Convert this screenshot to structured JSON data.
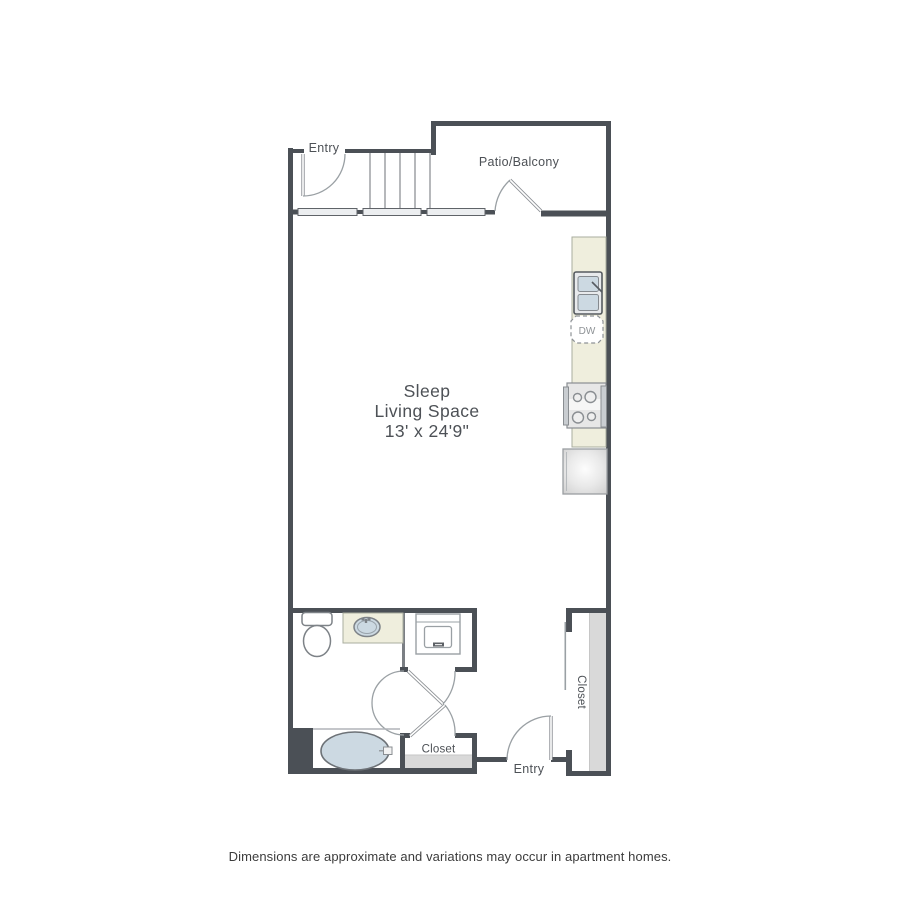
{
  "floor_plan": {
    "labels": {
      "entry_top": "Entry",
      "patio_balcony": "Patio/Balcony",
      "living_line1": "Sleep",
      "living_line2": "Living Space",
      "living_dimensions": "13' x 24'9\"",
      "dishwasher": "DW",
      "closet_bottom": "Closet",
      "closet_right": "Closet",
      "entry_bottom": "Entry"
    },
    "disclaimer": "Dimensions are approximate and variations may occur in apartment homes.",
    "colors": {
      "wall": "#4b5056",
      "line": "#8e9296",
      "counter": "#efeedd",
      "fixture_blue": "#ccd9e2",
      "shelf_gray": "#d9d9d9",
      "label_text": "#4d5156",
      "disclaimer_text": "#3c3c3c"
    }
  }
}
